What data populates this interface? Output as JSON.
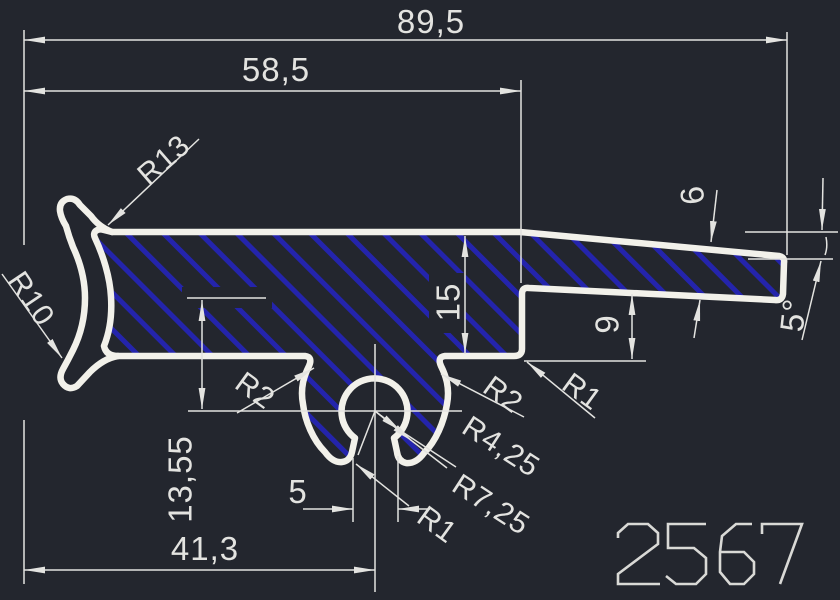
{
  "drawing": {
    "part_number": "2567",
    "colors": {
      "background": "#23262e",
      "hatch_blue": "#2424ac",
      "outline_white": "#f2f1ea",
      "dimension_gray": "#e3e3e0"
    },
    "dimensions": {
      "overall_width": {
        "label": "89,5"
      },
      "width_to_step": {
        "label": "58,5"
      },
      "width_to_clip_center": {
        "label": "41,3"
      },
      "body_height": {
        "label": "15"
      },
      "arm_thickness": {
        "label": "6"
      },
      "step_height": {
        "label": "9"
      },
      "arm_angle": {
        "label": "5°"
      },
      "clip_center_depth": {
        "label": "13,55"
      },
      "slot_width": {
        "label": "5"
      },
      "radius_top_lip": {
        "label": "R13"
      },
      "radius_left_face": {
        "label": "R10"
      },
      "radius_left_neck": {
        "label": "R2"
      },
      "radius_right_neck": {
        "label": "R2"
      },
      "radius_step_fillet": {
        "label": "R1"
      },
      "radius_clip_inner": {
        "label": "R4,25"
      },
      "radius_clip_outer": {
        "label": "R7,25"
      },
      "radius_clip_tip": {
        "label": "R1"
      }
    }
  }
}
